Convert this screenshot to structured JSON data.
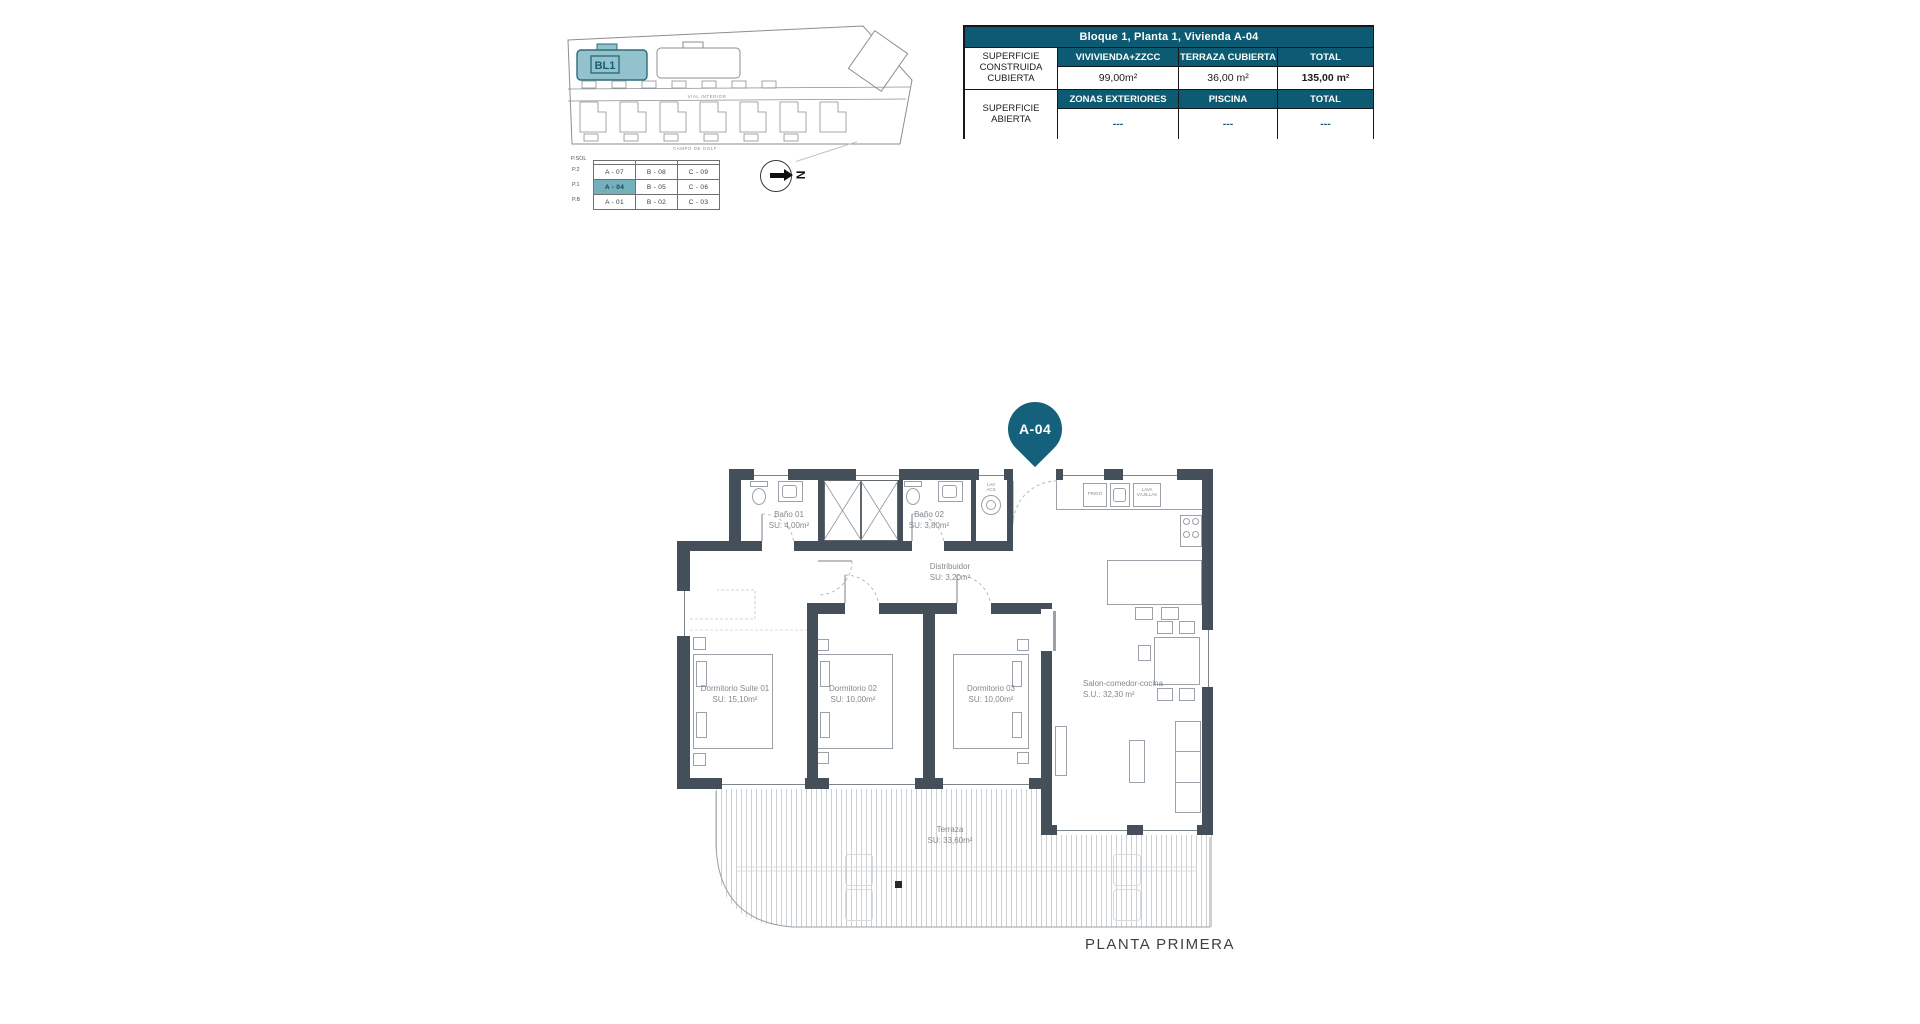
{
  "colors": {
    "teal": "#0d5b72",
    "pin_teal": "#15607a",
    "wall": "#454f5a",
    "highlight_cell": "#74afbc",
    "block_fill": "#93c2cc"
  },
  "site_plan": {
    "block_label": "BL1",
    "road_label": "VIAL INTERIOR",
    "golf_label": "CAMPO DE GOLF"
  },
  "unit_table": {
    "corner_label": "P.SOL",
    "floors": [
      "P.2",
      "P.1",
      "P.B"
    ],
    "rows": [
      [
        "A - 07",
        "B - 08",
        "C - 09"
      ],
      [
        "A - 04",
        "B - 05",
        "C - 06"
      ],
      [
        "A - 01",
        "B - 02",
        "C - 03"
      ]
    ],
    "highlighted_unit": "A - 04"
  },
  "compass": {
    "north_label": "N"
  },
  "info_table": {
    "title": "Bloque 1, Planta 1, Vivienda A-04",
    "row_groups": [
      {
        "label": "SUPERFICIE CONSTRUIDA CUBIERTA",
        "headers": [
          "VIVIVIENDA+ZZCC",
          "TERRAZA CUBIERTA",
          "TOTAL"
        ],
        "values": [
          "99,00m²",
          "36,00 m²",
          "135,00 m²"
        ]
      },
      {
        "label": "SUPERFICIE ABIERTA",
        "headers": [
          "ZONAS EXTERIORES",
          "PISCINA",
          "TOTAL"
        ],
        "values": [
          "---",
          "---",
          "---"
        ]
      }
    ]
  },
  "plan": {
    "pin_label": "A-04",
    "caption": "PLANTA PRIMERA",
    "rooms": {
      "bano01": {
        "name": "Baño 01",
        "area": "SU: 4,00m²"
      },
      "bano02": {
        "name": "Baño 02",
        "area": "SU: 3,80m²"
      },
      "distribuidor": {
        "name": "Distribuidor",
        "area": "SU: 3,20m²"
      },
      "suite": {
        "name": "Dormitorio Suite 01",
        "area": "SU: 15,10m²"
      },
      "dorm02": {
        "name": "Dormitorio 02",
        "area": "SU: 10,00m²"
      },
      "dorm03": {
        "name": "Dormitorio 03",
        "area": "SU: 10,00m²"
      },
      "salon": {
        "name": "Salon-comedor-cocina",
        "area": "S.U.: 32,30 m²"
      },
      "terraza": {
        "name": "Terraza",
        "area": "SU: 33,60m²"
      }
    },
    "kitchen": {
      "fridge": "FRIGO",
      "dishwasher": "LAVA VAJILLAS",
      "laundry_1": "LAV",
      "laundry_2": "ACS"
    }
  }
}
